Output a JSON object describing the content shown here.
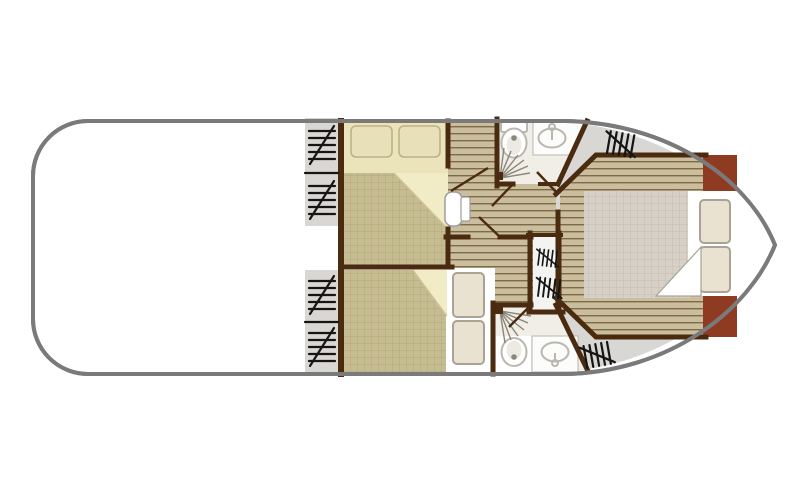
{
  "diagram": {
    "type": "boat-floor-plan",
    "orientation": "stern-left-rounded, bow-right-pointed",
    "rooms": [
      {
        "id": "open-area",
        "desc": "empty white saloon/deck area at stern (left half)",
        "fixtures": []
      },
      {
        "id": "cabin-top",
        "desc": "double-bed cabin, upper port side",
        "fixtures": [
          "double-bed",
          "pillow",
          "pillow",
          "folded-sheet"
        ]
      },
      {
        "id": "cabin-bottom",
        "desc": "double-bed cabin, lower port side",
        "fixtures": [
          "double-bed",
          "pillow",
          "pillow",
          "folded-sheet"
        ]
      },
      {
        "id": "bathroom-top",
        "desc": "shower room upper centre",
        "fixtures": [
          "toilet",
          "washbasin-with-tap",
          "shower-spray"
        ]
      },
      {
        "id": "bathroom-bottom",
        "desc": "shower room lower centre",
        "fixtures": [
          "toilet",
          "washbasin-with-tap",
          "shower-spray"
        ]
      },
      {
        "id": "master-cabin-bow",
        "desc": "bow double cabin with large bed",
        "fixtures": [
          "double-bed",
          "pillow",
          "pillow",
          "folded-sheet",
          "bow-locker"
        ]
      },
      {
        "id": "corridor",
        "desc": "central plank-floor passage",
        "fixtures": [
          "entry-steps"
        ]
      }
    ],
    "windows": {
      "side_strip_upper_pair": 2,
      "side_strip_lower_pair": 2,
      "bow_top": 1,
      "bow_bottom": 1,
      "companionway_hatch_marks": 2
    },
    "door_leaves": 5
  },
  "palette": {
    "white": "#ffffff",
    "hull_stroke": "#7a7a7a",
    "deck_gray": "#d8d7d3",
    "wall": "#4a2b10",
    "plank_base": "#cbbe9e",
    "plank_line": "#7d6b45",
    "khaki_base": "#c6bc92",
    "khaki_line": "#b1a77b",
    "blanket_base": "#d6d0c6",
    "blanket_line": "#c3bdb2",
    "cream": "#ebe4bb",
    "cream_bright": "#f1ebc6",
    "fold_line": "#cfc69a",
    "pillow_cream": "#e8e0b8",
    "pillow_cream_border": "#bcb287",
    "pillow_light": "#e9e2d0",
    "pillow_light_border": "#a9a396",
    "maroon": "#8e3b22",
    "bath_floor": "#f0eee7",
    "counter_white": "#fcfcfa",
    "fixture_stroke": "#b9b7b0",
    "fixture_inner": "#eceae2",
    "fixture_dot": "#8a887d",
    "shower_ray": "#8a8578",
    "window_mark": "#151515",
    "step_stroke": "#9e9e9e"
  }
}
